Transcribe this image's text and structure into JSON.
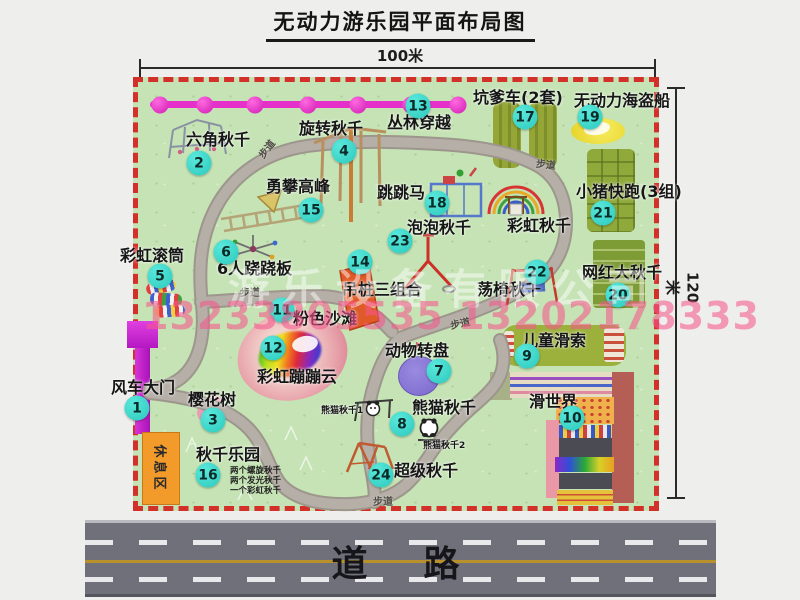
{
  "title": "无动力游乐园平面布局图",
  "dimensions": {
    "horizontal": "100米",
    "vertical": "120米"
  },
  "road": {
    "label": "道　路"
  },
  "watermarks": {
    "company": "游乐设备有限公司",
    "phone": "13233805535 13202178333"
  },
  "map": {
    "rest_area_label": "休息区",
    "path_label": "步道",
    "path_label_positions": [
      {
        "x": 256,
        "y": 141,
        "rot": -52
      },
      {
        "x": 536,
        "y": 156,
        "rot": 6
      },
      {
        "x": 240,
        "y": 284,
        "rot": 0
      },
      {
        "x": 450,
        "y": 315,
        "rot": -12
      },
      {
        "x": 373,
        "y": 493,
        "rot": 0
      }
    ],
    "swing_park_notes": [
      "两个螺旋秋千",
      "两个发光秋千",
      "一个彩虹秋千"
    ],
    "extra_labels": [
      {
        "text": "彩虹秋千",
        "x": 507,
        "y": 218,
        "small": false
      },
      {
        "text": "熊猫秋千1",
        "x": 321,
        "y": 407,
        "small": true
      },
      {
        "text": "熊猫秋千2",
        "x": 423,
        "y": 442,
        "small": true
      }
    ],
    "attractions": [
      {
        "num": 1,
        "label": "风车大门",
        "badge": [
          137,
          408
        ],
        "label_pos": [
          111,
          380
        ]
      },
      {
        "num": 2,
        "label": "六角秋千",
        "badge": [
          199,
          163
        ],
        "label_pos": [
          186,
          132
        ]
      },
      {
        "num": 3,
        "label": "樱花树",
        "badge": [
          213,
          420
        ],
        "label_pos": [
          188,
          392
        ]
      },
      {
        "num": 4,
        "label": "旋转秋千",
        "badge": [
          344,
          151
        ],
        "label_pos": [
          299,
          121
        ]
      },
      {
        "num": 5,
        "label": "彩虹滚筒",
        "badge": [
          160,
          276
        ],
        "label_pos": [
          120,
          248
        ]
      },
      {
        "num": 6,
        "label": "6人跷跷板",
        "badge": [
          226,
          252
        ],
        "label_pos": [
          217,
          261
        ]
      },
      {
        "num": 7,
        "label": "动物转盘",
        "badge": [
          439,
          371
        ],
        "label_pos": [
          385,
          343
        ]
      },
      {
        "num": 8,
        "label": "熊猫秋千",
        "badge": [
          402,
          424
        ],
        "label_pos": [
          412,
          400
        ]
      },
      {
        "num": 9,
        "label": "儿童滑索",
        "badge": [
          527,
          356
        ],
        "label_pos": [
          522,
          333
        ]
      },
      {
        "num": 10,
        "label": "滑世界",
        "badge": [
          572,
          418
        ],
        "label_pos": [
          529,
          394
        ]
      },
      {
        "num": 11,
        "label": "粉色沙滩",
        "badge": [
          282,
          310
        ],
        "label_pos": [
          293,
          311
        ]
      },
      {
        "num": 12,
        "label": "彩虹蹦蹦云",
        "badge": [
          273,
          348
        ],
        "label_pos": [
          257,
          369
        ]
      },
      {
        "num": 13,
        "label": "丛林穿越",
        "badge": [
          418,
          106
        ],
        "label_pos": [
          387,
          115
        ]
      },
      {
        "num": 14,
        "label": "吊桩三组合",
        "badge": [
          360,
          262
        ],
        "label_pos": [
          342,
          282
        ]
      },
      {
        "num": 15,
        "label": "勇攀高峰",
        "badge": [
          311,
          210
        ],
        "label_pos": [
          266,
          179
        ]
      },
      {
        "num": 16,
        "label": "秋千乐园",
        "badge": [
          208,
          475
        ],
        "label_pos": [
          196,
          447
        ]
      },
      {
        "num": 17,
        "label": "坑爹车(2套)",
        "badge": [
          525,
          117
        ],
        "label_pos": [
          473,
          90
        ]
      },
      {
        "num": 18,
        "label": "跳跳马",
        "badge": [
          437,
          203
        ],
        "label_pos": [
          377,
          185
        ]
      },
      {
        "num": 19,
        "label": "无动力海盗船",
        "badge": [
          590,
          117
        ],
        "label_pos": [
          574,
          93
        ]
      },
      {
        "num": 20,
        "label": "网红大秋千",
        "badge": [
          618,
          295
        ],
        "label_pos": [
          582,
          265
        ]
      },
      {
        "num": 21,
        "label": "小猪快跑(3组)",
        "badge": [
          603,
          213
        ],
        "label_pos": [
          576,
          184
        ]
      },
      {
        "num": 22,
        "label": "荡椅秋千",
        "badge": [
          537,
          272
        ],
        "label_pos": [
          477,
          282
        ]
      },
      {
        "num": 23,
        "label": "泡泡秋千",
        "badge": [
          400,
          241
        ],
        "label_pos": [
          407,
          220
        ]
      },
      {
        "num": 24,
        "label": "超级秋千",
        "badge": [
          381,
          475
        ],
        "label_pos": [
          394,
          463
        ]
      }
    ]
  }
}
